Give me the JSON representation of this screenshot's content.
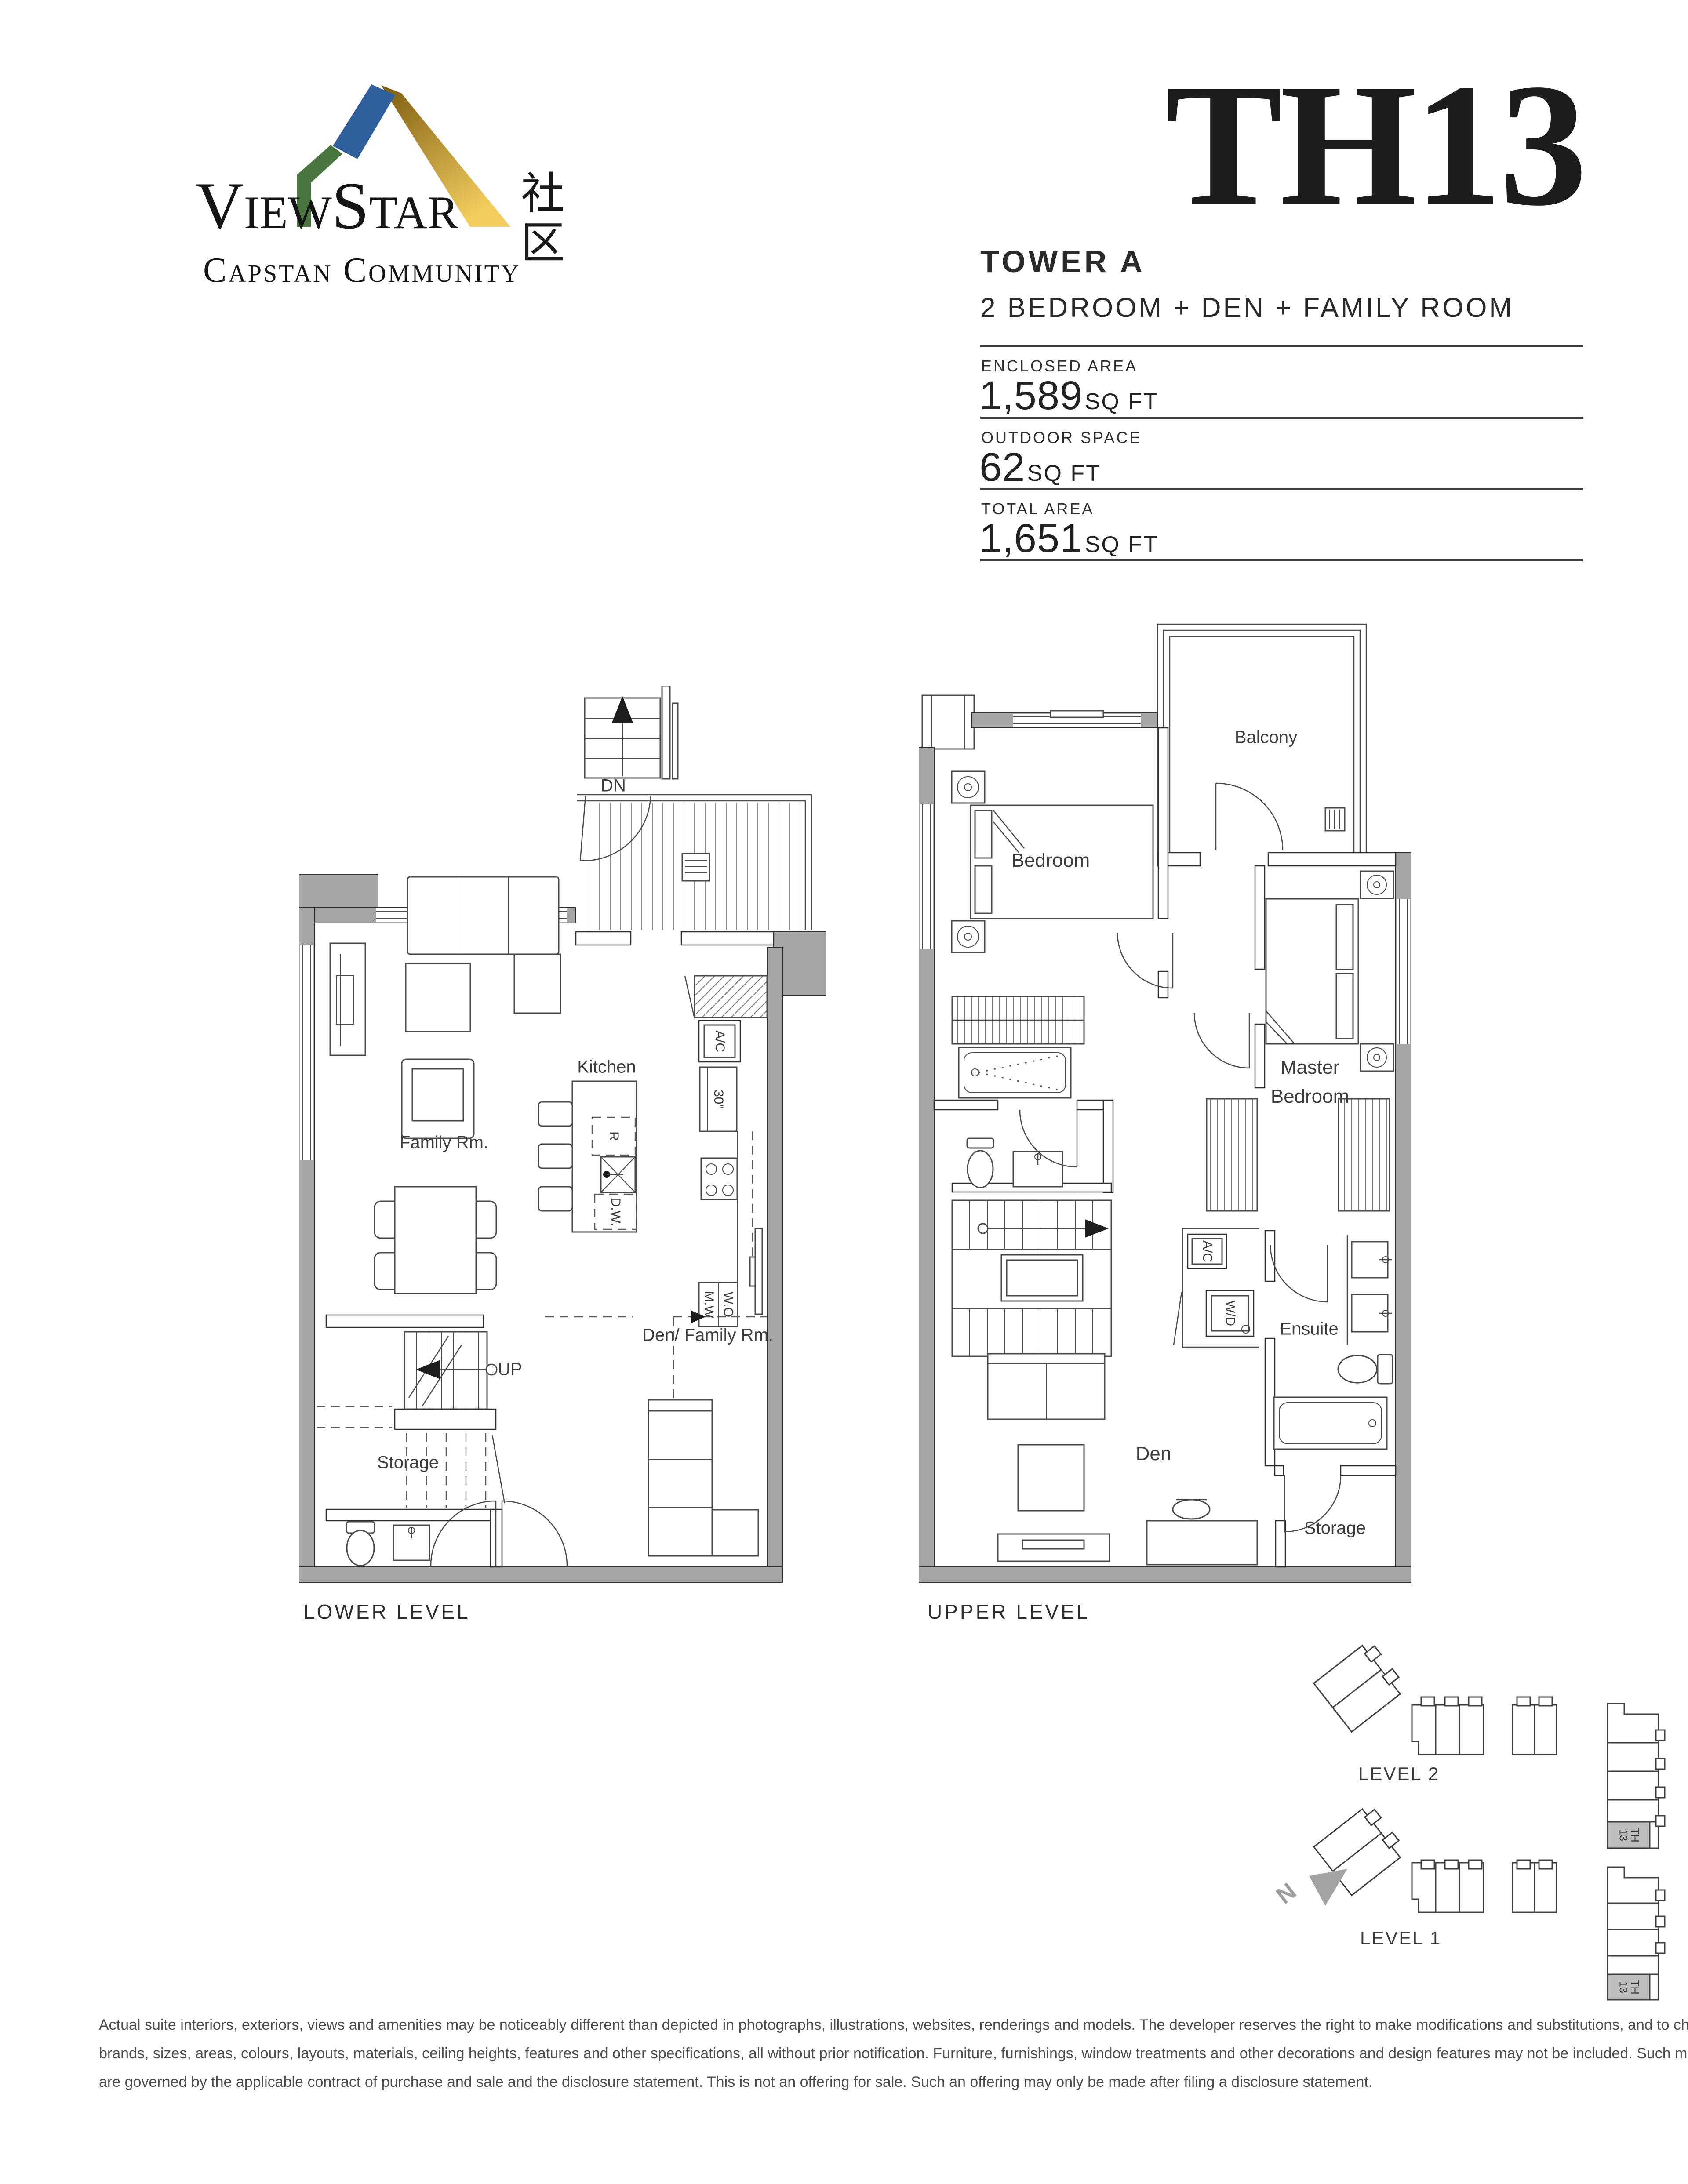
{
  "header": {
    "logo": {
      "brand": "ViewStar",
      "brand_cjk": "社区",
      "community": "Capstan Community"
    },
    "unit_code": "TH13",
    "tower": "TOWER A",
    "unit_type": "2 BEDROOM + DEN + FAMILY ROOM",
    "areas": [
      {
        "label": "ENCLOSED AREA",
        "value": "1,589",
        "unit": "SQ FT"
      },
      {
        "label": "OUTDOOR SPACE",
        "value": "62",
        "unit": "SQ FT"
      },
      {
        "label": "TOTAL AREA",
        "value": "1,651",
        "unit": "SQ FT"
      }
    ]
  },
  "lower_level": {
    "title": "LOWER LEVEL",
    "labels": {
      "dn": "DN",
      "kitchen": "Kitchen",
      "family_room": "Family Rm.",
      "ac": "A/C",
      "fridge": "30\"",
      "range": "R",
      "dishwasher": "D.W.",
      "microwave": "M.W",
      "wall_oven": "W.O",
      "up": "UP",
      "storage": "Storage",
      "den_family": "Den/ Family Rm."
    }
  },
  "upper_level": {
    "title": "UPPER LEVEL",
    "labels": {
      "balcony": "Balcony",
      "bedroom": "Bedroom",
      "master_bedroom": "Master Bedroom",
      "ac": "A/C",
      "washer_dryer": "W/D",
      "ensuite": "Ensuite",
      "den": "Den",
      "storage": "Storage"
    }
  },
  "key_plans": {
    "level2": "LEVEL 2",
    "level1": "LEVEL 1",
    "unit_tag": "TH 13",
    "north": "N"
  },
  "disclaimer": {
    "line1": "Actual suite interiors, exteriors, views and amenities may be noticeably different than depicted in photographs, illustrations, websites, renderings and models.  The developer reserves the right to make modifications and substitutions, and to change",
    "line2": "brands, sizes, areas, colours, layouts, materials, ceiling heights, features and other specifications, all without prior notification.  Furniture, furnishings, window treatments and other decorations and design features may not be included.  Such matters",
    "line3": "are governed by the applicable contract of purchase and sale and the disclosure statement. This is not an offering for sale. Such an offering may only be made after filing a disclosure statement."
  }
}
